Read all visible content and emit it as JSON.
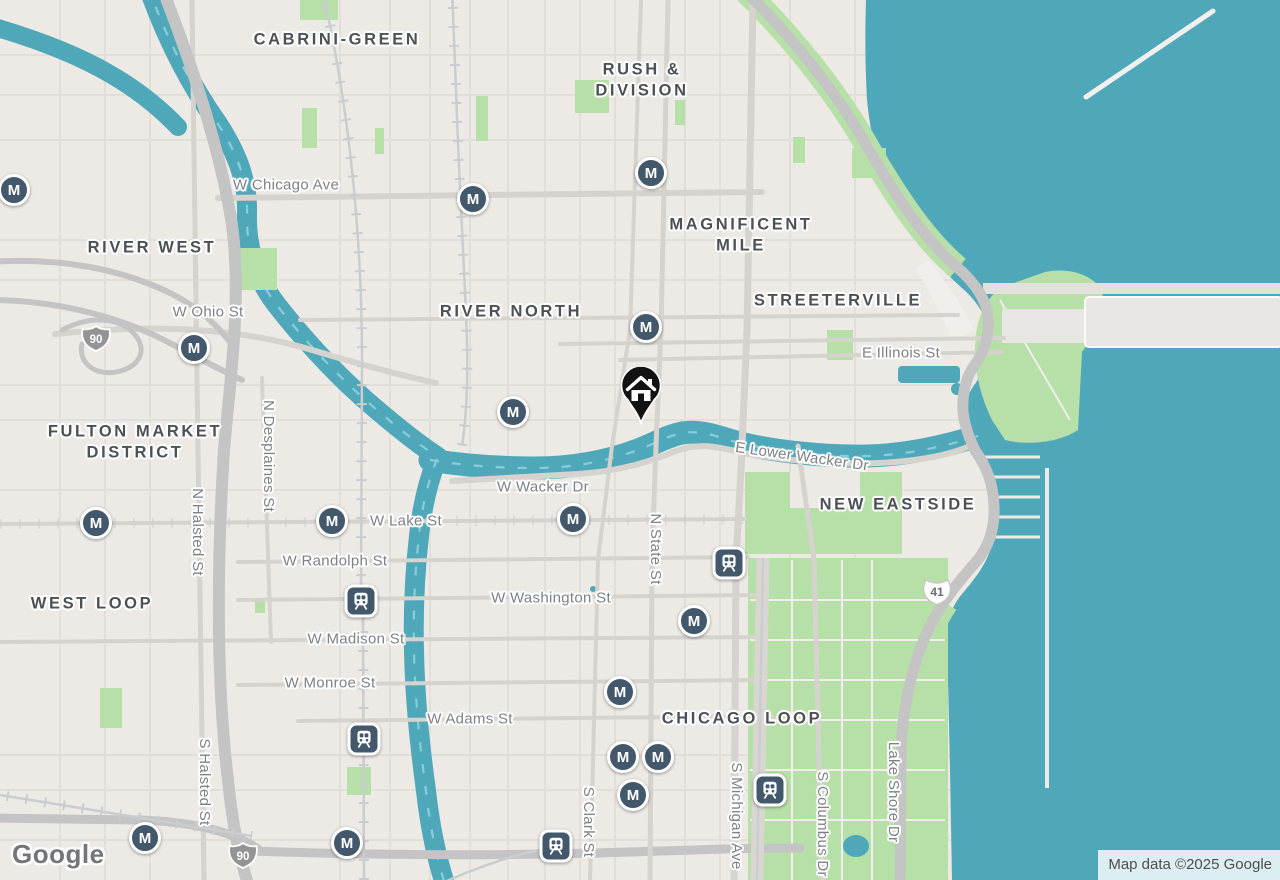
{
  "map": {
    "attribution": "Map data ©2025 Google",
    "logo_text": "Google",
    "metro_letter": "M",
    "colors": {
      "water": "#4fa8ba",
      "waterDash": "#8dd2df",
      "land": "#edeae6",
      "park": "#b7dfa8",
      "roadMinor": "#e2dfdb",
      "roadMajor": "#d6d3cf",
      "highway": "#c4c4c4",
      "rail": "#c9cdd0",
      "marker": "#44586c",
      "hood": "#4c5156",
      "street": "#7e8287",
      "pin": "#121212",
      "shieldInterstate": "#929496",
      "shieldUs": "#fdfdfd",
      "shieldUsText": "#6d6d6d"
    },
    "neighborhoods": [
      {
        "text": "CABRINI-GREEN",
        "x": 337,
        "y": 40
      },
      {
        "text": "RUSH &\nDIVISION",
        "x": 642,
        "y": 81
      },
      {
        "text": "RIVER WEST",
        "x": 152,
        "y": 248
      },
      {
        "text": "MAGNIFICENT\nMILE",
        "x": 741,
        "y": 236
      },
      {
        "text": "RIVER NORTH",
        "x": 511,
        "y": 312
      },
      {
        "text": "STREETERVILLE",
        "x": 838,
        "y": 301
      },
      {
        "text": "FULTON MARKET\nDISTRICT",
        "x": 135,
        "y": 443
      },
      {
        "text": "WEST LOOP",
        "x": 92,
        "y": 604
      },
      {
        "text": "NEW EASTSIDE",
        "x": 898,
        "y": 505
      },
      {
        "text": "CHICAGO LOOP",
        "x": 742,
        "y": 719
      }
    ],
    "streets": [
      {
        "text": "W Chicago Ave",
        "x": 286,
        "y": 185,
        "rot": 0
      },
      {
        "text": "W Ohio St",
        "x": 208,
        "y": 312,
        "rot": 0
      },
      {
        "text": "E Illinois St",
        "x": 901,
        "y": 353,
        "rot": 0
      },
      {
        "text": "E Lower Wacker Dr",
        "x": 802,
        "y": 457,
        "rot": 8
      },
      {
        "text": "W Wacker Dr",
        "x": 543,
        "y": 487,
        "rot": 0
      },
      {
        "text": "W Lake St",
        "x": 406,
        "y": 521,
        "rot": 0
      },
      {
        "text": "W Randolph St",
        "x": 335,
        "y": 561,
        "rot": 0
      },
      {
        "text": "W Washington St",
        "x": 551,
        "y": 598,
        "rot": 0
      },
      {
        "text": "W Madison St",
        "x": 356,
        "y": 639,
        "rot": 0
      },
      {
        "text": "W Monroe St",
        "x": 330,
        "y": 683,
        "rot": 0
      },
      {
        "text": "W Adams St",
        "x": 470,
        "y": 719,
        "rot": 0
      },
      {
        "text": "N Desplaines St",
        "x": 268,
        "y": 456,
        "rot": 90
      },
      {
        "text": "N Halsted St",
        "x": 197,
        "y": 532,
        "rot": 90
      },
      {
        "text": "S Halsted St",
        "x": 204,
        "y": 782,
        "rot": 90
      },
      {
        "text": "N State St",
        "x": 655,
        "y": 549,
        "rot": 90
      },
      {
        "text": "S Clark St",
        "x": 588,
        "y": 822,
        "rot": 90
      },
      {
        "text": "S Michigan Ave",
        "x": 736,
        "y": 816,
        "rot": 90
      },
      {
        "text": "S Columbus Dr",
        "x": 822,
        "y": 824,
        "rot": 90
      },
      {
        "text": "Lake Shore Dr",
        "x": 893,
        "y": 792,
        "rot": 90
      }
    ],
    "metro_stations": [
      {
        "x": 14,
        "y": 190
      },
      {
        "x": 473,
        "y": 199
      },
      {
        "x": 651,
        "y": 173
      },
      {
        "x": 194,
        "y": 348
      },
      {
        "x": 646,
        "y": 327
      },
      {
        "x": 513,
        "y": 412
      },
      {
        "x": 96,
        "y": 523
      },
      {
        "x": 332,
        "y": 521
      },
      {
        "x": 573,
        "y": 519
      },
      {
        "x": 694,
        "y": 621
      },
      {
        "x": 620,
        "y": 692
      },
      {
        "x": 623,
        "y": 757
      },
      {
        "x": 658,
        "y": 757
      },
      {
        "x": 633,
        "y": 795
      },
      {
        "x": 145,
        "y": 838
      },
      {
        "x": 347,
        "y": 843
      }
    ],
    "rail_stations": [
      {
        "x": 361,
        "y": 601
      },
      {
        "x": 364,
        "y": 739
      },
      {
        "x": 729,
        "y": 563
      },
      {
        "x": 770,
        "y": 790
      },
      {
        "x": 556,
        "y": 846
      }
    ],
    "shields": [
      {
        "type": "interstate",
        "label": "90",
        "x": 96,
        "y": 341
      },
      {
        "type": "interstate",
        "label": "90",
        "x": 243,
        "y": 858
      },
      {
        "type": "us",
        "label": "41",
        "x": 937,
        "y": 594
      }
    ],
    "home_marker": {
      "x": 641,
      "y": 393
    }
  }
}
